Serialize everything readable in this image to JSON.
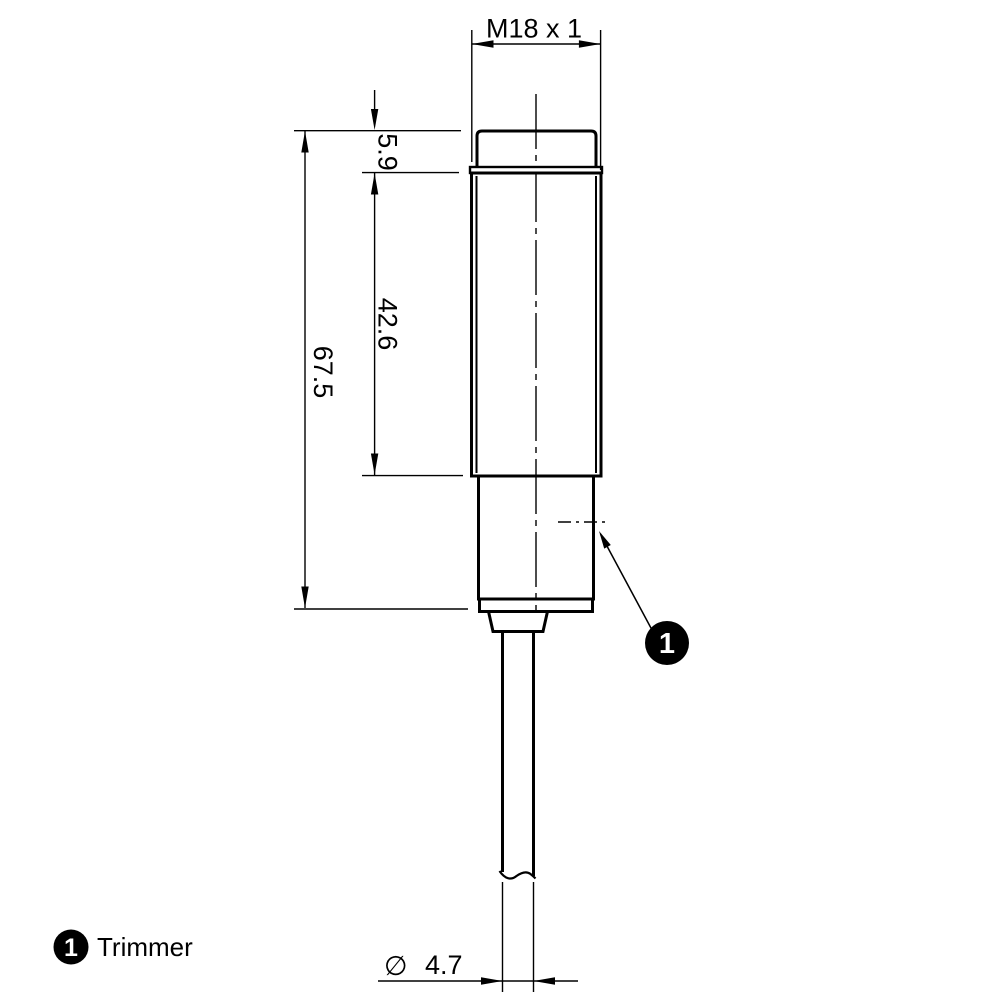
{
  "drawing": {
    "type": "dimensional-drawing",
    "subject": "threaded cylindrical sensor with cable",
    "thread_spec": "M18 x 1",
    "dimensions": {
      "overall_length": "67.5",
      "thread_length": "42.6",
      "head_height": "5.9",
      "diameter_symbol": "∅",
      "cable_diameter_value": "4.7"
    },
    "callout": {
      "number": "1"
    },
    "legend": {
      "number": "1",
      "label": "Trimmer"
    },
    "colors": {
      "line": "#000000",
      "background": "#ffffff"
    }
  }
}
